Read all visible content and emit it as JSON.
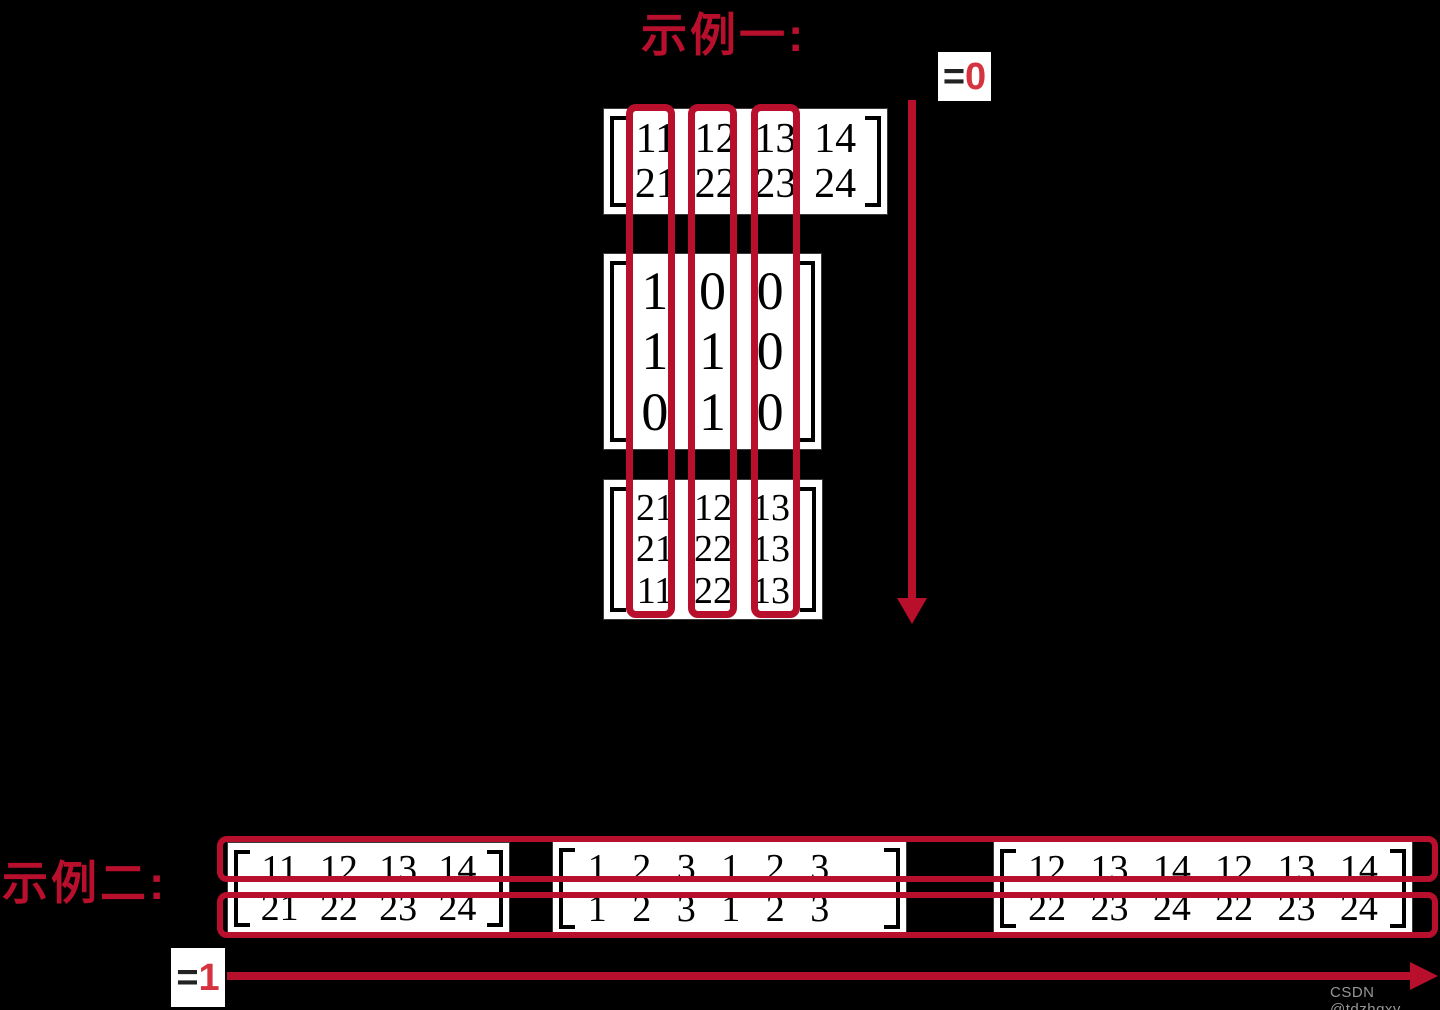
{
  "example1": {
    "title": "示例一:",
    "dim_label": {
      "eq": "=",
      "value": "0"
    },
    "input_matrix": [
      [
        "11",
        "12",
        "13",
        "14"
      ],
      [
        "21",
        "22",
        "23",
        "24"
      ]
    ],
    "index_matrix": [
      [
        "1",
        "0",
        "0"
      ],
      [
        "1",
        "1",
        "0"
      ],
      [
        "0",
        "1",
        "0"
      ]
    ],
    "result_matrix": [
      [
        "21",
        "12",
        "13"
      ],
      [
        "21",
        "22",
        "13"
      ],
      [
        "11",
        "22",
        "13"
      ]
    ]
  },
  "example2": {
    "title": "示例二:",
    "dim_label": {
      "eq": "=",
      "value": "1"
    },
    "input_matrix": [
      [
        "11",
        "12",
        "13",
        "14"
      ],
      [
        "21",
        "22",
        "23",
        "24"
      ]
    ],
    "index_matrix": [
      [
        "1",
        "2",
        "3",
        "1",
        "2",
        "3"
      ],
      [
        "1",
        "2",
        "3",
        "1",
        "2",
        "3"
      ]
    ],
    "result_matrix": [
      [
        "12",
        "13",
        "14",
        "12",
        "13",
        "14"
      ],
      [
        "22",
        "23",
        "24",
        "22",
        "23",
        "24"
      ]
    ]
  },
  "watermark": "CSDN @tdzhqxy",
  "colors": {
    "background": "#000000",
    "highlight_red": "#b80f2d",
    "dim_digit_red": "#d4333f",
    "matrix_background": "#ffffff",
    "matrix_text": "#000000",
    "watermark_gray": "#969696"
  }
}
